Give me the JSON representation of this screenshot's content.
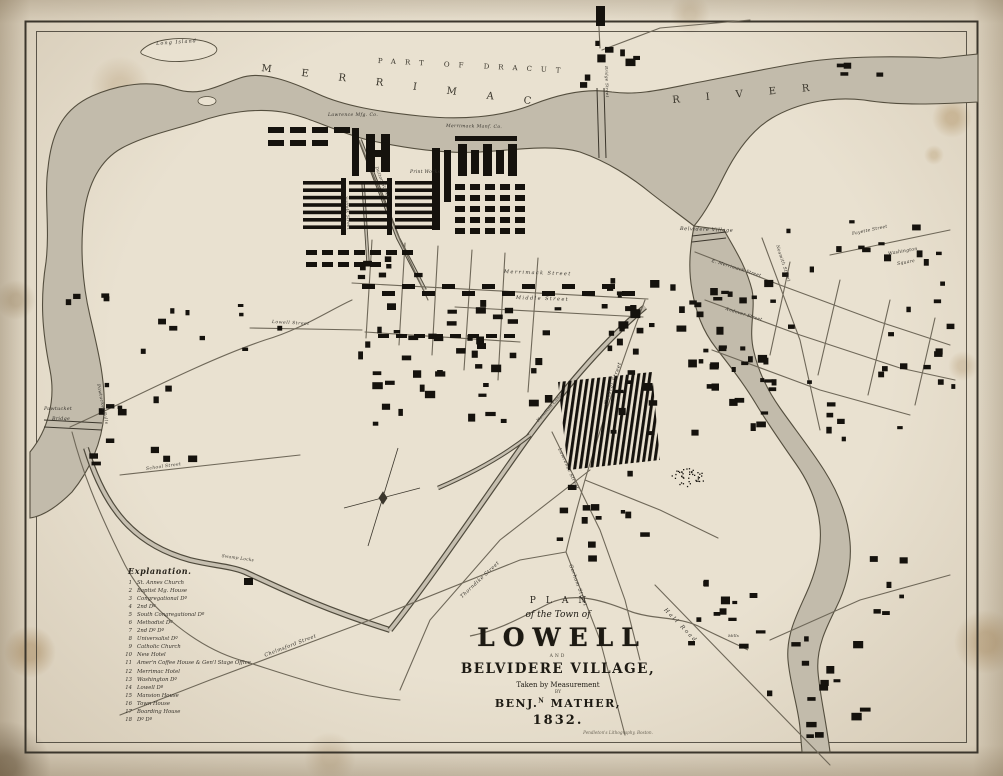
{
  "title_block": {
    "plan": "PLAN",
    "of_the_town_of": "of the Town of",
    "town": "LOWELL",
    "and": "AND",
    "village": "BELVIDERE VILLAGE,",
    "taken_by": "Taken by Measurement",
    "by": "BY",
    "author_pre": "BENJ.",
    "author_sup": "N",
    "author_post": " MATHER,",
    "year": "1832.",
    "imprint": "Pendleton's Lithography, Boston."
  },
  "legend": {
    "heading": "Explanation.",
    "entries": [
      {
        "num": "1",
        "label": "St. Annes Church"
      },
      {
        "num": "2",
        "label": "Baptist Mg. House"
      },
      {
        "num": "3",
        "label": "Congregational Dº"
      },
      {
        "num": "4",
        "label": "2nd Dº"
      },
      {
        "num": "5",
        "label": "South Congregational Dº"
      },
      {
        "num": "6",
        "label": "Methodist Dº"
      },
      {
        "num": "7",
        "label": "2nd Dº Dº"
      },
      {
        "num": "8",
        "label": "Universalist Dº"
      },
      {
        "num": "9",
        "label": "Catholic Church"
      },
      {
        "num": "10",
        "label": "New Hotel"
      },
      {
        "num": "11",
        "label": "Amer'n Coffee House & Gen'l Stage Office"
      },
      {
        "num": "12",
        "label": "Merrimac Hotel"
      },
      {
        "num": "13",
        "label": "Washington Dº"
      },
      {
        "num": "14",
        "label": "Lowell Dº"
      },
      {
        "num": "15",
        "label": "Mansion House"
      },
      {
        "num": "16",
        "label": "Town House"
      },
      {
        "num": "17",
        "label": "Boarding House"
      },
      {
        "num": "18",
        "label": "Dº Dº"
      }
    ]
  },
  "map_labels": [
    {
      "id": "part-of-dracut",
      "text": "PART OF DRACUT",
      "x": 378,
      "y": 58,
      "rot": 3,
      "size": 7,
      "ls": 9,
      "cls": "caps"
    },
    {
      "id": "merrimac-river-word1",
      "text": "MERRIMAC",
      "x": 262,
      "y": 64,
      "rot": 7,
      "size": 10,
      "ls": 30,
      "cls": "caps"
    },
    {
      "id": "merrimac-river-word2",
      "text": "RIVER",
      "x": 672,
      "y": 96,
      "rot": -5,
      "size": 10,
      "ls": 26,
      "cls": "caps"
    },
    {
      "id": "long-island",
      "text": "Long Island",
      "x": 156,
      "y": 42,
      "rot": -4,
      "size": 5,
      "ls": 1,
      "cls": "it"
    },
    {
      "id": "lawrence-mfg-co",
      "text": "Lawrence Mfg. Co.",
      "x": 328,
      "y": 114,
      "rot": 0,
      "size": 4.5,
      "ls": 0.4,
      "cls": "it"
    },
    {
      "id": "merrimack-manf-co",
      "text": "Merrimack Manf. Co.",
      "x": 446,
      "y": 125,
      "rot": 1,
      "size": 4.5,
      "ls": 0.4,
      "cls": "it"
    },
    {
      "id": "print-works",
      "text": "Print Works",
      "x": 410,
      "y": 171,
      "rot": 0,
      "size": 4.5,
      "ls": 0.3,
      "cls": "it"
    },
    {
      "id": "belvidere-village",
      "text": "Belvidere Village",
      "x": 680,
      "y": 227,
      "rot": 2,
      "size": 5,
      "ls": 0.6,
      "cls": "it"
    },
    {
      "id": "washington-square-line1",
      "text": "Washington",
      "x": 888,
      "y": 253,
      "rot": -10,
      "size": 4.5,
      "ls": 0.3,
      "cls": "it"
    },
    {
      "id": "washington-square-line2",
      "text": "Square",
      "x": 897,
      "y": 263,
      "rot": -10,
      "size": 4.5,
      "ls": 0.3,
      "cls": "it"
    },
    {
      "id": "fayette-street",
      "text": "Fayette Street",
      "x": 852,
      "y": 233,
      "rot": -12,
      "size": 4.4,
      "ls": 0.3,
      "cls": "it"
    },
    {
      "id": "nesmith-street",
      "text": "Nesmith Street",
      "x": 778,
      "y": 245,
      "rot": 72,
      "size": 4.4,
      "ls": 0.3,
      "cls": "it"
    },
    {
      "id": "pawtucket-bridge-line1",
      "text": "Pawtucket",
      "x": 44,
      "y": 408,
      "rot": 0,
      "size": 4.8,
      "ls": 0.3,
      "cls": "it"
    },
    {
      "id": "pawtucket-bridge-line2",
      "text": "Bridge",
      "x": 52,
      "y": 418,
      "rot": 0,
      "size": 4.8,
      "ls": 0.3,
      "cls": "it"
    },
    {
      "id": "pawtucket-falls",
      "text": "Pawtucket Falls",
      "x": 99,
      "y": 384,
      "rot": 78,
      "size": 4.4,
      "ls": 0.4,
      "cls": "it"
    },
    {
      "id": "merrimack-street",
      "text": "Merrimack Street",
      "x": 504,
      "y": 270,
      "rot": 2,
      "size": 5,
      "ls": 1.4,
      "cls": "it"
    },
    {
      "id": "middle-street",
      "text": "Middle Street",
      "x": 516,
      "y": 296,
      "rot": 2,
      "size": 5,
      "ls": 1.4,
      "cls": "it"
    },
    {
      "id": "lowell-street",
      "text": "Lowell Street",
      "x": 272,
      "y": 321,
      "rot": 3,
      "size": 4.4,
      "ls": 0.6,
      "cls": "it"
    },
    {
      "id": "central-street",
      "text": "Central Street",
      "x": 604,
      "y": 404,
      "rot": -71,
      "size": 5,
      "ls": 0.6,
      "cls": "it"
    },
    {
      "id": "gorham-street",
      "text": "Gorham Street",
      "x": 572,
      "y": 564,
      "rot": 70,
      "size": 5,
      "ls": 0.5,
      "cls": "it"
    },
    {
      "id": "thorndike-street",
      "text": "Thorndike Street",
      "x": 460,
      "y": 596,
      "rot": -43,
      "size": 5,
      "ls": 0.5,
      "cls": "it"
    },
    {
      "id": "chelmsford-street",
      "text": "Chelmsford Street",
      "x": 264,
      "y": 654,
      "rot": -21,
      "size": 5,
      "ls": 0.5,
      "cls": "it"
    },
    {
      "id": "lawrence-street",
      "text": "Lawrence Street",
      "x": 560,
      "y": 448,
      "rot": 66,
      "size": 4.6,
      "ls": 0.4,
      "cls": "it"
    },
    {
      "id": "hall-road",
      "text": "Hall Road",
      "x": 666,
      "y": 608,
      "rot": 46,
      "size": 5.5,
      "ls": 2,
      "cls": "it"
    },
    {
      "id": "swamp-locks",
      "text": "Swamp Locks",
      "x": 222,
      "y": 554,
      "rot": 8,
      "size": 4.2,
      "ls": 0.3,
      "cls": "it"
    },
    {
      "id": "hamilton-canal",
      "text": "Hamilton Canal",
      "x": 536,
      "y": 420,
      "rot": -48,
      "size": 4.2,
      "ls": 0.3,
      "cls": "it"
    },
    {
      "id": "school-street",
      "text": "School Street",
      "x": 146,
      "y": 468,
      "rot": -8,
      "size": 4.4,
      "ls": 0.4,
      "cls": "it"
    },
    {
      "id": "suffolk-street",
      "text": "Suffolk Street",
      "x": 348,
      "y": 196,
      "rot": 86,
      "size": 4.2,
      "ls": 0.3,
      "cls": "it"
    },
    {
      "id": "dutton-street",
      "text": "Dutton Street",
      "x": 378,
      "y": 166,
      "rot": 69,
      "size": 4.2,
      "ls": 0.3,
      "cls": "it"
    },
    {
      "id": "bridge-street",
      "text": "Bridge Street",
      "x": 608,
      "y": 66,
      "rot": 88,
      "size": 4,
      "ls": 0.3,
      "cls": "it"
    },
    {
      "id": "east-merrimack-street",
      "text": "E. Merrimack Street",
      "x": 712,
      "y": 260,
      "rot": 17,
      "size": 4.4,
      "ls": 0.3,
      "cls": "it"
    },
    {
      "id": "andover-street",
      "text": "Andover Street",
      "x": 726,
      "y": 308,
      "rot": 17,
      "size": 4.4,
      "ls": 0.3,
      "cls": "it"
    },
    {
      "id": "mills",
      "text": "Mills",
      "x": 728,
      "y": 634,
      "rot": 0,
      "size": 4,
      "ls": 0.2,
      "cls": "it"
    }
  ]
}
